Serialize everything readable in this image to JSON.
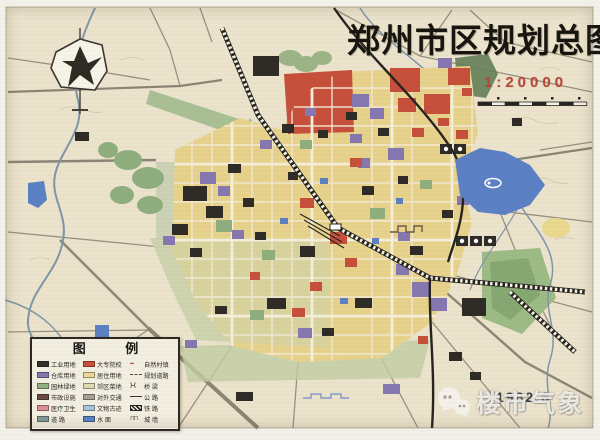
{
  "title": "郑州市区规划总图",
  "scale": {
    "label": "1:20000"
  },
  "date": "1982.6",
  "watermark": {
    "text": "楼市气象"
  },
  "legend": {
    "title": "图 例",
    "items": [
      {
        "label": "工业用地",
        "symbol": "sym-swatch",
        "color": "#33302b"
      },
      {
        "label": "大专院校",
        "symbol": "sym-swatch",
        "color": "#c6503c"
      },
      {
        "label": "自然村镇",
        "symbol": "sym-village",
        "color": "#b5483a"
      },
      {
        "label": "仓库用地",
        "symbol": "sym-swatch",
        "color": "#8577b0"
      },
      {
        "label": "居住用地",
        "symbol": "sym-swatch",
        "color": "#ecd89a"
      },
      {
        "label": "规划道路",
        "symbol": "sym-dashes",
        "color": "#4a463f"
      },
      {
        "label": "园林绿地",
        "symbol": "sym-swatch",
        "color": "#93b183"
      },
      {
        "label": "郊区菜地",
        "symbol": "sym-swatch",
        "color": "#dfd9b6"
      },
      {
        "label": "桥 梁",
        "symbol": "sym-bridge",
        "color": "#3a362f"
      },
      {
        "label": "市政设施",
        "symbol": "sym-swatch",
        "color": "#6b4a44"
      },
      {
        "label": "对外交通",
        "symbol": "sym-swatch",
        "color": "#a8a095"
      },
      {
        "label": "公 路",
        "symbol": "sym-line",
        "color": "#3a362f"
      },
      {
        "label": "医疗卫生",
        "symbol": "sym-swatch",
        "color": "#d98f97"
      },
      {
        "label": "文物古迹",
        "symbol": "sym-swatch",
        "color": "#a9c4da"
      },
      {
        "label": "铁 路",
        "symbol": "sym-hatch",
        "color": "#26231f"
      },
      {
        "label": "道 路",
        "symbol": "sym-swatch",
        "color": "#7f9a99"
      },
      {
        "label": "水 面",
        "symbol": "sym-swatch",
        "color": "#5b80c4"
      },
      {
        "label": "城 墙",
        "symbol": "sym-wall",
        "color": "#5c4a33"
      }
    ]
  },
  "colors": {
    "paper": "#f3f1ea",
    "map_base": "#ece3cd",
    "residential_yellow": "#e7d28c",
    "industrial_black": "#2e2b26",
    "warehouse_purple": "#8577b0",
    "college_red": "#c6503c",
    "green": "#93b183",
    "water_blue": "#5b80c4",
    "railway_black": "#26231f",
    "scale_red": "#b5483a"
  }
}
